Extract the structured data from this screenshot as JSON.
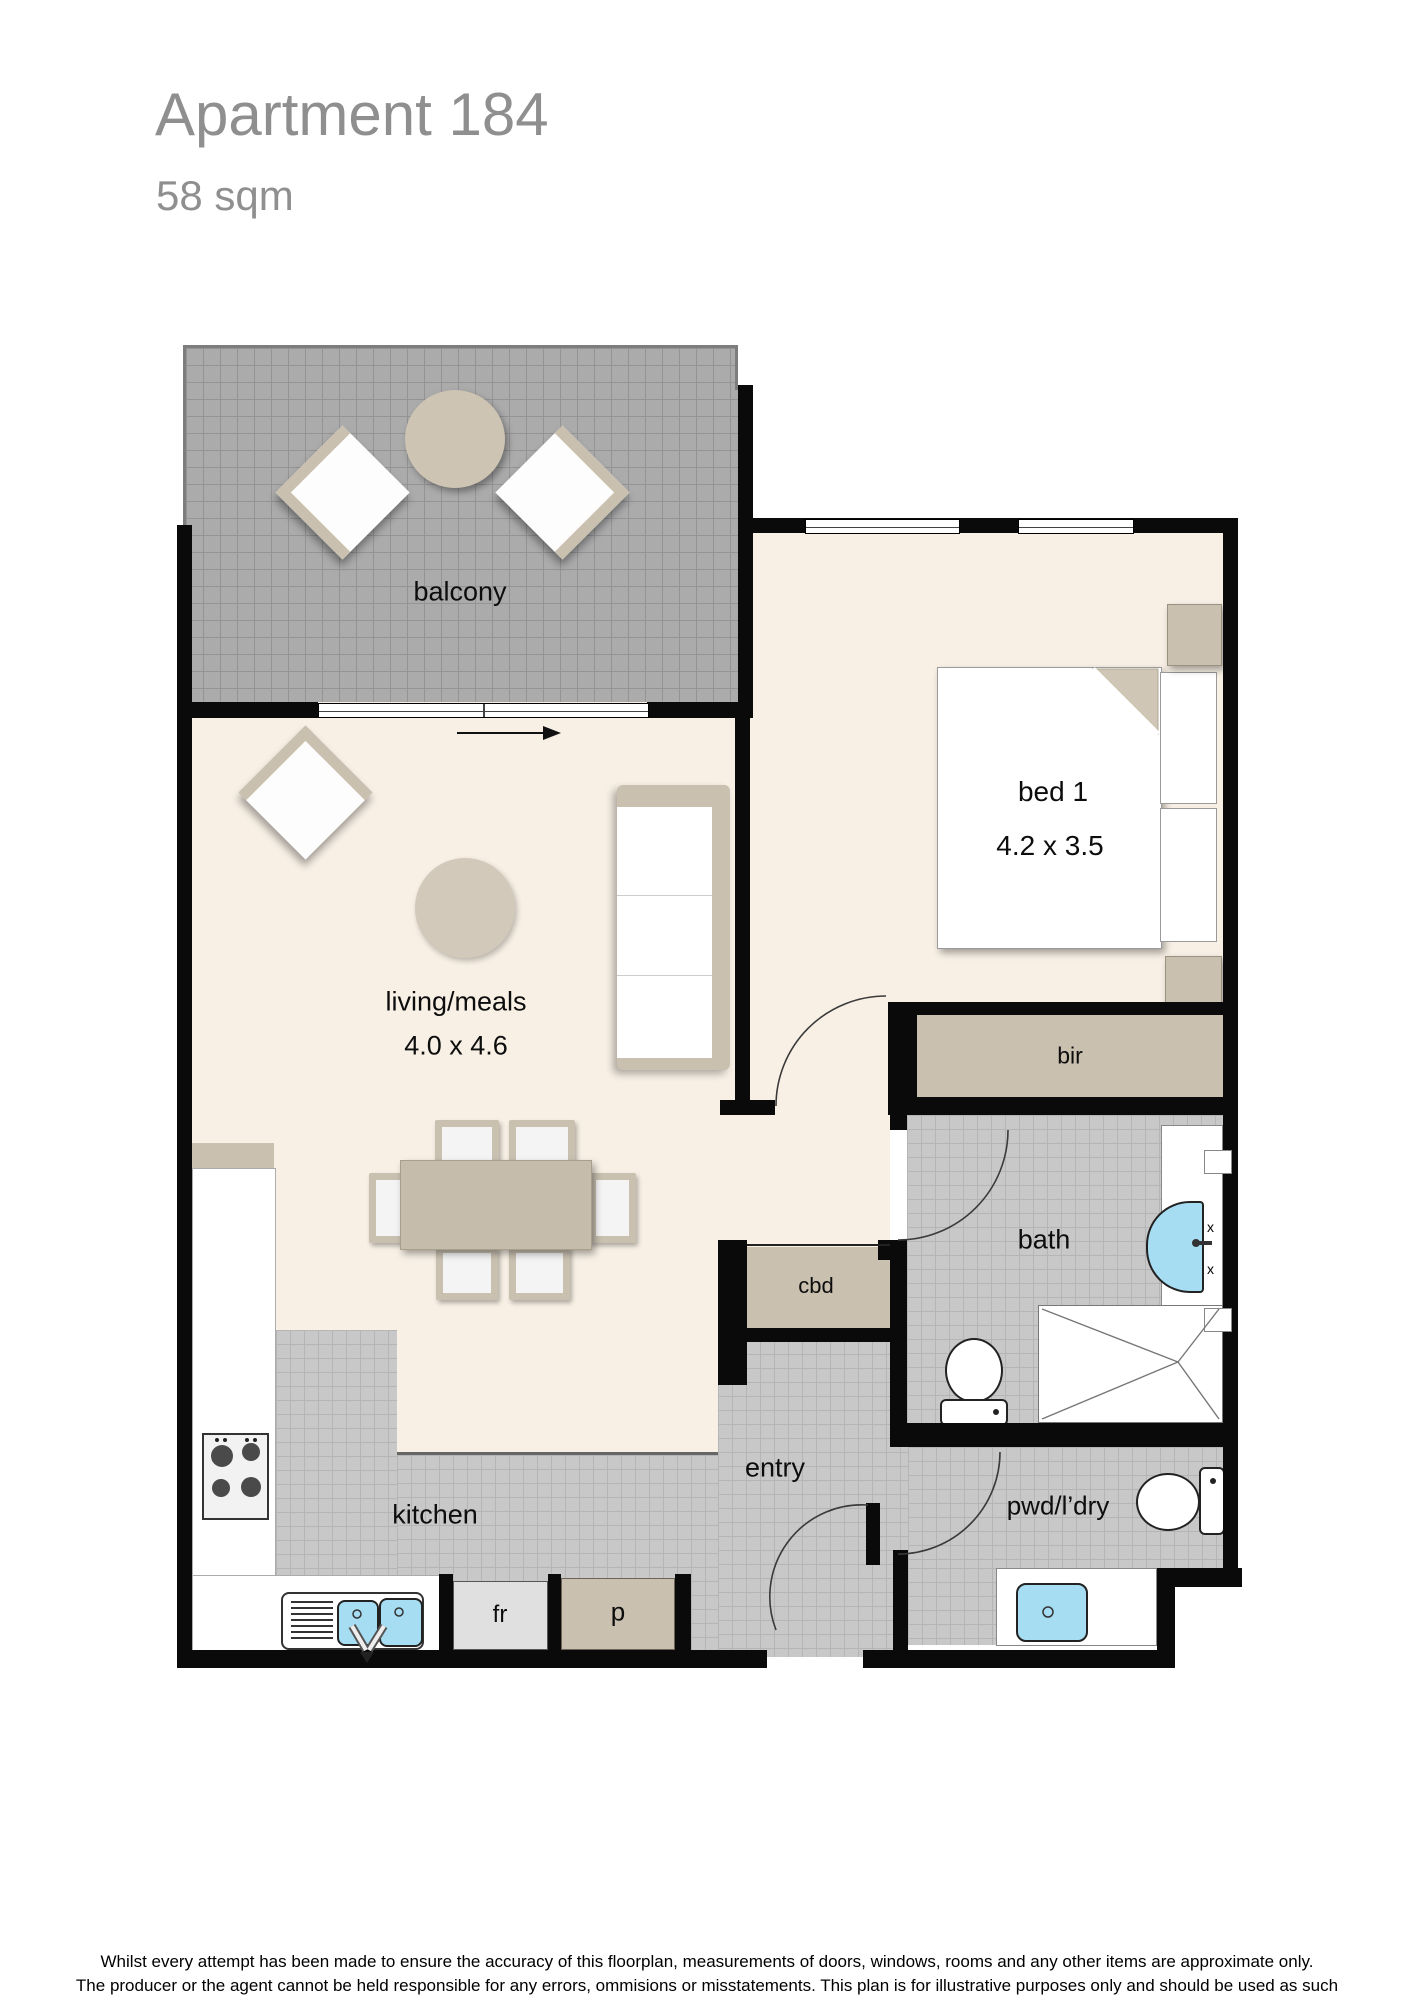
{
  "page": {
    "title": "Apartment 184",
    "subtitle": "58 sqm",
    "footer_line1": "Whilst every attempt has been made to ensure the accuracy of this floorplan, measurements of doors, windows, rooms and any other items are approximate only.",
    "footer_line2": "The producer or the agent cannot be held responsible for any errors, ommisions or misstatements. This plan is for illustrative purposes only and should be used as such"
  },
  "rooms": {
    "balcony": {
      "label": "balcony"
    },
    "living": {
      "label": "living/meals",
      "dimensions": "4.0 x 4.6"
    },
    "bedroom": {
      "label": "bed 1",
      "dimensions": "4.2 x 3.5"
    },
    "bir": {
      "label": "bir"
    },
    "cbd": {
      "label": "cbd"
    },
    "bath": {
      "label": "bath"
    },
    "entry": {
      "label": "entry"
    },
    "pwd_ldry": {
      "label": "pwd/l’dry"
    },
    "kitchen": {
      "label": "kitchen"
    },
    "fridge": {
      "label": "fr"
    },
    "pantry": {
      "label": "p"
    }
  },
  "colors": {
    "wall": "#0a0a0a",
    "floor_cream": "#f8f0e5",
    "balcony_tile": "#ababab",
    "interior_tile": "#c8c8c8",
    "furniture_tan": "#c9c0b0",
    "sink_blue": "#a7ddf2",
    "title_gray": "#8f8f8f"
  }
}
